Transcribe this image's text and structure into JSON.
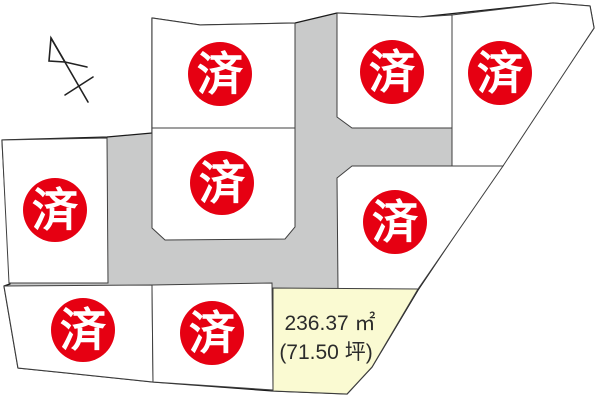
{
  "map": {
    "title": "land-subdivision-lot-map",
    "sold_stamp": "済",
    "sold_count": 8,
    "lot_count": 9,
    "available_lot": {
      "area_m2": "236.37 ㎡",
      "area_tsubo": "(71.50 坪)"
    },
    "icons": {
      "north_arrow": "compass-north-arrow"
    },
    "colors": {
      "sold_stamp_red": "#e60012",
      "road_gray": "#c9caca",
      "lot_white": "#ffffff",
      "available_yellow": "#fafad2",
      "outline_black": "#1a1a1a"
    },
    "lots": [
      {
        "id": 1,
        "status": "sold"
      },
      {
        "id": 2,
        "status": "sold"
      },
      {
        "id": 3,
        "status": "sold"
      },
      {
        "id": 4,
        "status": "sold"
      },
      {
        "id": 5,
        "status": "sold"
      },
      {
        "id": 6,
        "status": "sold"
      },
      {
        "id": 7,
        "status": "sold"
      },
      {
        "id": 8,
        "status": "sold"
      },
      {
        "id": 9,
        "status": "available"
      }
    ]
  }
}
